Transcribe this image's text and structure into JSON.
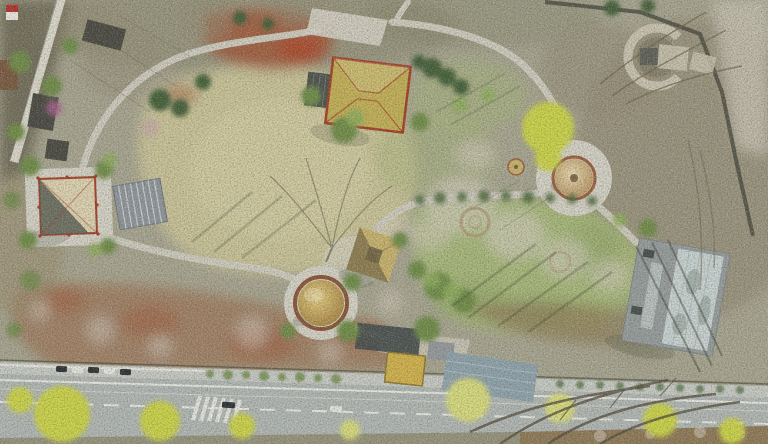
{
  "meta": {
    "description": "Aerial drone photograph of a landscaped heritage park in early spring: winding grey footpaths link several traditional pavilions (hip-roof, pyramidal, thatched), a golden dome, a round thatched kiosk, a C-shaped stone-ring ruin and a modern glass-roofed building, surrounded by dry meadows, rust-red shrubs, white blossom scrub and a green lawn with circular earthworks; an asphalt road with lane markings, a zebra crossing, parked cars and yellow-green street trees runs along the bottom edge."
  },
  "palette": {
    "scrub_base": "#a8a692",
    "scrub_dark": "#848268",
    "scrub_warm": "#9a8a6a",
    "outside_dark": "#6f6a58",
    "wall_stone": "#dcd9cd",
    "dark_roof": "#4a4a44",
    "meadow": "#cbc59a",
    "meadow_light": "#d7d0a6",
    "lawn": "#a8b87a",
    "lawn_dark": "#8aa363",
    "hedge_green": "#4f6b3f",
    "tree_green": "#6f8c4a",
    "tree_green_light": "#8fae5e",
    "evergreen": "#44603a",
    "spring_yellow": "#ccd449",
    "spring_yellow_pale": "#d8dc7e",
    "blossom": "#d9d0c6",
    "blossom_pink": "#c9a8a8",
    "magenta_tree": "#a8608e",
    "red_shrub": "#a2583a",
    "red_shrub_bright": "#b04a2c",
    "brown_scrub": "#8f7a58",
    "rust_scrub": "#9a6444",
    "path": "#cfccc0",
    "plaza": "#d6d3c8",
    "road": "#b2b8b6",
    "road_edge": "#c8cbc6",
    "road_line": "#eef0ea",
    "roof_tan": "#c3b157",
    "roof_red": "#a43f28",
    "porch_slate": "#4d534e",
    "roof_cream": "#ded3b2",
    "roof_shadow": "#5a5e55",
    "ribbed_gray": "#8f969c",
    "rib_line": "#d8dde0",
    "thatch": "#c9b36e",
    "thatch_dark": "#6e6244",
    "dome_hi": "#e6cf82",
    "dome_lo": "#a07c3c",
    "dome_rim": "#8a5535",
    "cone_hi": "#ead9b2",
    "cone_lo": "#b08c58",
    "cone_rim": "#9a5f3d",
    "stone_ring": "#cac4b2",
    "glass": "#c9d4d4",
    "glass_frame": "#969d9d",
    "metal_blue": "#8fa3ad",
    "dark_building": "#474f4e",
    "entrance_yellow": "#d2b24c",
    "bare_mottle": "#958d78",
    "outside_path": "#c4c0b0",
    "fence_dark": "#3f4238",
    "branch": "#6b654f",
    "branch_dark": "#564f40",
    "shadow": "#3c4430",
    "earth_ring": "#b09a78",
    "white_car": "#e8e8e4",
    "dark_car": "#2e3234",
    "sign_white": "#ece9e2",
    "sign_red": "#b23230"
  },
  "scene": {
    "features": [
      {
        "name": "stone-wall",
        "label": "Light stone boundary wall, upper left"
      },
      {
        "name": "outer-buildings",
        "label": "Dark-roofed buildings outside the west wall"
      },
      {
        "name": "signboard",
        "label": "Small red-and-white sign, top-left corner"
      },
      {
        "name": "main-pavilion",
        "label": "Tan hip-roof pavilion with red eaves and dark porch canopy, top centre"
      },
      {
        "name": "west-pavilion",
        "label": "Square pavilion with cream/slate pyramidal roof and red columns, left"
      },
      {
        "name": "ribbed-canopy",
        "label": "Ribbed grey canopy beside west pavilion"
      },
      {
        "name": "thatched-pavilion",
        "label": "Square thatched-roof pavilion, centre"
      },
      {
        "name": "golden-dome",
        "label": "Golden dome in a round paved rim, lower centre"
      },
      {
        "name": "round-pavilion",
        "label": "Round thatched kiosk on a circular plaza, centre right"
      },
      {
        "name": "stone-circle",
        "label": "C-shaped stone ring ruin, top right"
      },
      {
        "name": "glass-building",
        "label": "Modern grey building with reflective glass roof, right"
      },
      {
        "name": "entrance-complex",
        "label": "Entrance buildings with yellow courtyard and blue-grey metal roof, bottom centre"
      },
      {
        "name": "great-lawn",
        "label": "Green lawn with circular stone earthworks"
      },
      {
        "name": "central-meadow",
        "label": "Pale dry meadow crossed by bare-tree shadows"
      },
      {
        "name": "red-shrubs",
        "label": "Rust-red shrub patch, upper centre"
      },
      {
        "name": "blossom-scrub",
        "label": "Whitish-pink blossoming scrub"
      },
      {
        "name": "walking-paths",
        "label": "Winding grey footpaths linking the pavilions"
      },
      {
        "name": "boundary-fence",
        "label": "Dark fence along the north-east park edge"
      },
      {
        "name": "road",
        "label": "Asphalt road with white lane markings along the bottom"
      },
      {
        "name": "crosswalk",
        "label": "Zebra crossing on the road"
      },
      {
        "name": "parked-cars",
        "label": "Row of parked cars by the kerb"
      },
      {
        "name": "street-trees",
        "label": "Yellow-green spring street trees over the road"
      }
    ]
  }
}
